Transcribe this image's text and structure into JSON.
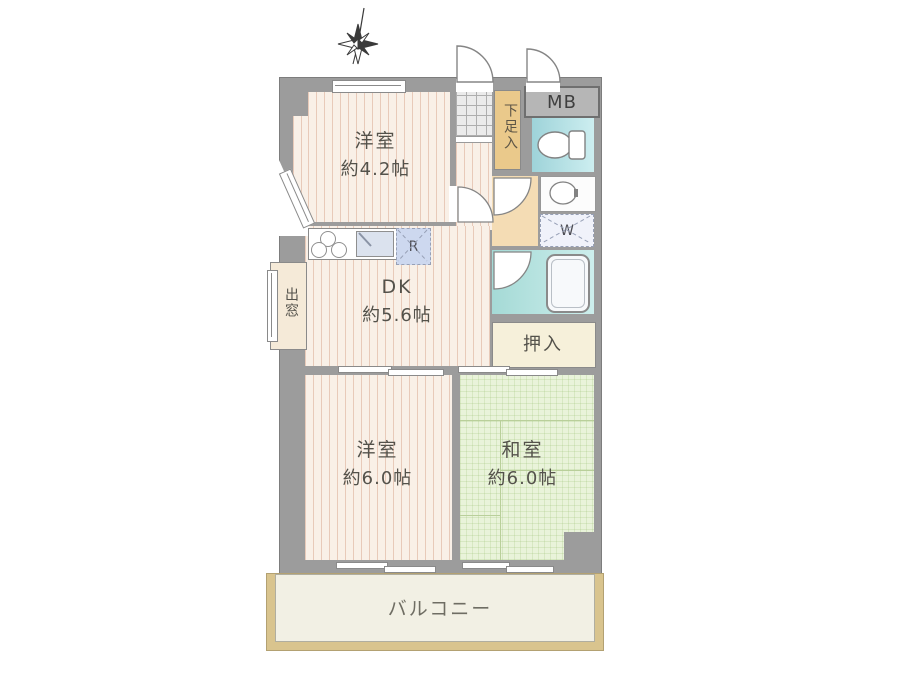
{
  "floorplan": {
    "rooms": {
      "western_room_small": {
        "name": "洋室",
        "size": "約4.2帖"
      },
      "dining_kitchen": {
        "name": "DK",
        "size": "約5.6帖"
      },
      "western_room_large": {
        "name": "洋室",
        "size": "約6.0帖"
      },
      "japanese_room": {
        "name": "和室",
        "size": "約6.0帖"
      }
    },
    "labels": {
      "balcony": "バルコニー",
      "closet": "押入",
      "bay_window": "出窓",
      "shoe_cabinet": "下足入",
      "meter_box": "MB",
      "washing_machine": "W",
      "refrigerator": "R"
    },
    "icons": {
      "compass": "compass-north-icon",
      "toilet": "toilet-icon",
      "washbasin": "washbasin-icon",
      "bathtub": "bathtub-icon",
      "stove": "stove-burners-icon",
      "kitchen_sink": "kitchen-sink-icon"
    },
    "colors": {
      "wall": "#9c9c9c",
      "wood_floor": "#f9f0e7",
      "wood_stripe": "#d9a98e",
      "tatami": "#e9f3da",
      "hallway_tan": "#f4dcb4",
      "shoe_cabinet_bg": "#eac98b",
      "toilet_bg": "#a9dcdf",
      "bath_bg": "#aedcd8",
      "closet_bg": "#f6f0da",
      "balcony_frame": "#d9c48e",
      "balcony_floor": "#f2f0e4",
      "text": "#54524b"
    }
  }
}
